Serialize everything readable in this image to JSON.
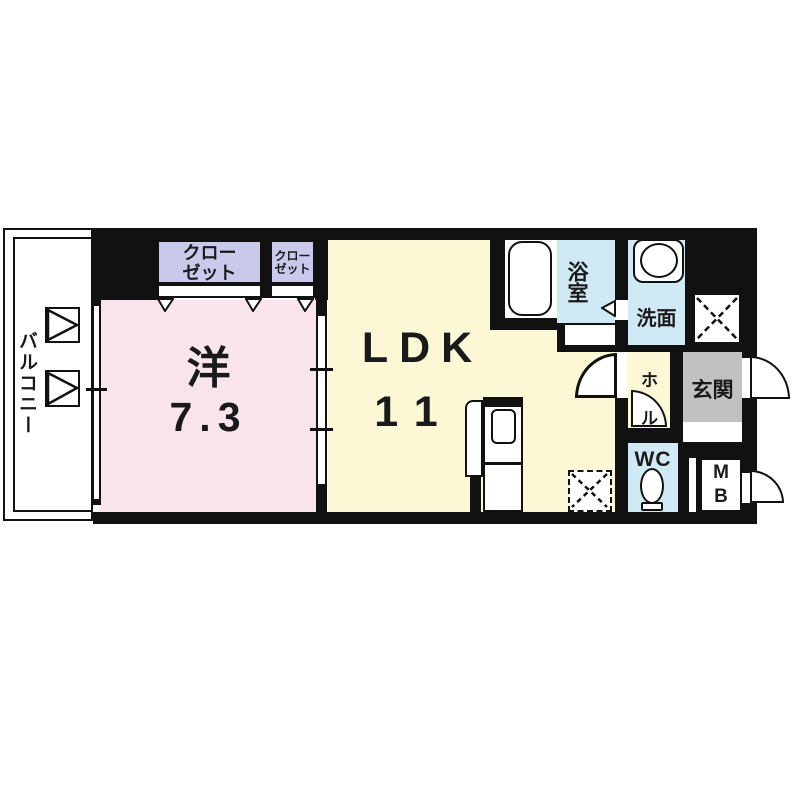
{
  "title": "1LDK apartment floor plan",
  "colors": {
    "wall": "#111111",
    "western_room": "#f9e4ee",
    "ldk": "#fcf8d6",
    "closet": "#c9c9ec",
    "wet_area": "#cfe9f5",
    "entrance": "#c2c1c2",
    "white": "#ffffff"
  },
  "rooms": {
    "balcony": {
      "label": "バルコニー"
    },
    "western": {
      "label": "洋",
      "size": "7.3"
    },
    "ldk": {
      "label": "LDK",
      "size": "11"
    },
    "closet_large": {
      "lines": [
        "クロー",
        "ゼット"
      ]
    },
    "closet_small": {
      "lines": [
        "クロー",
        "ゼット"
      ]
    },
    "bath": {
      "label": "浴室"
    },
    "washroom": {
      "label": "洗面"
    },
    "entrance": {
      "label": "玄関"
    },
    "hall": {
      "chars": [
        "ホ",
        "ル"
      ]
    },
    "wc": {
      "label": "WC"
    },
    "meter_box": {
      "lines": [
        "M",
        "B"
      ]
    }
  }
}
